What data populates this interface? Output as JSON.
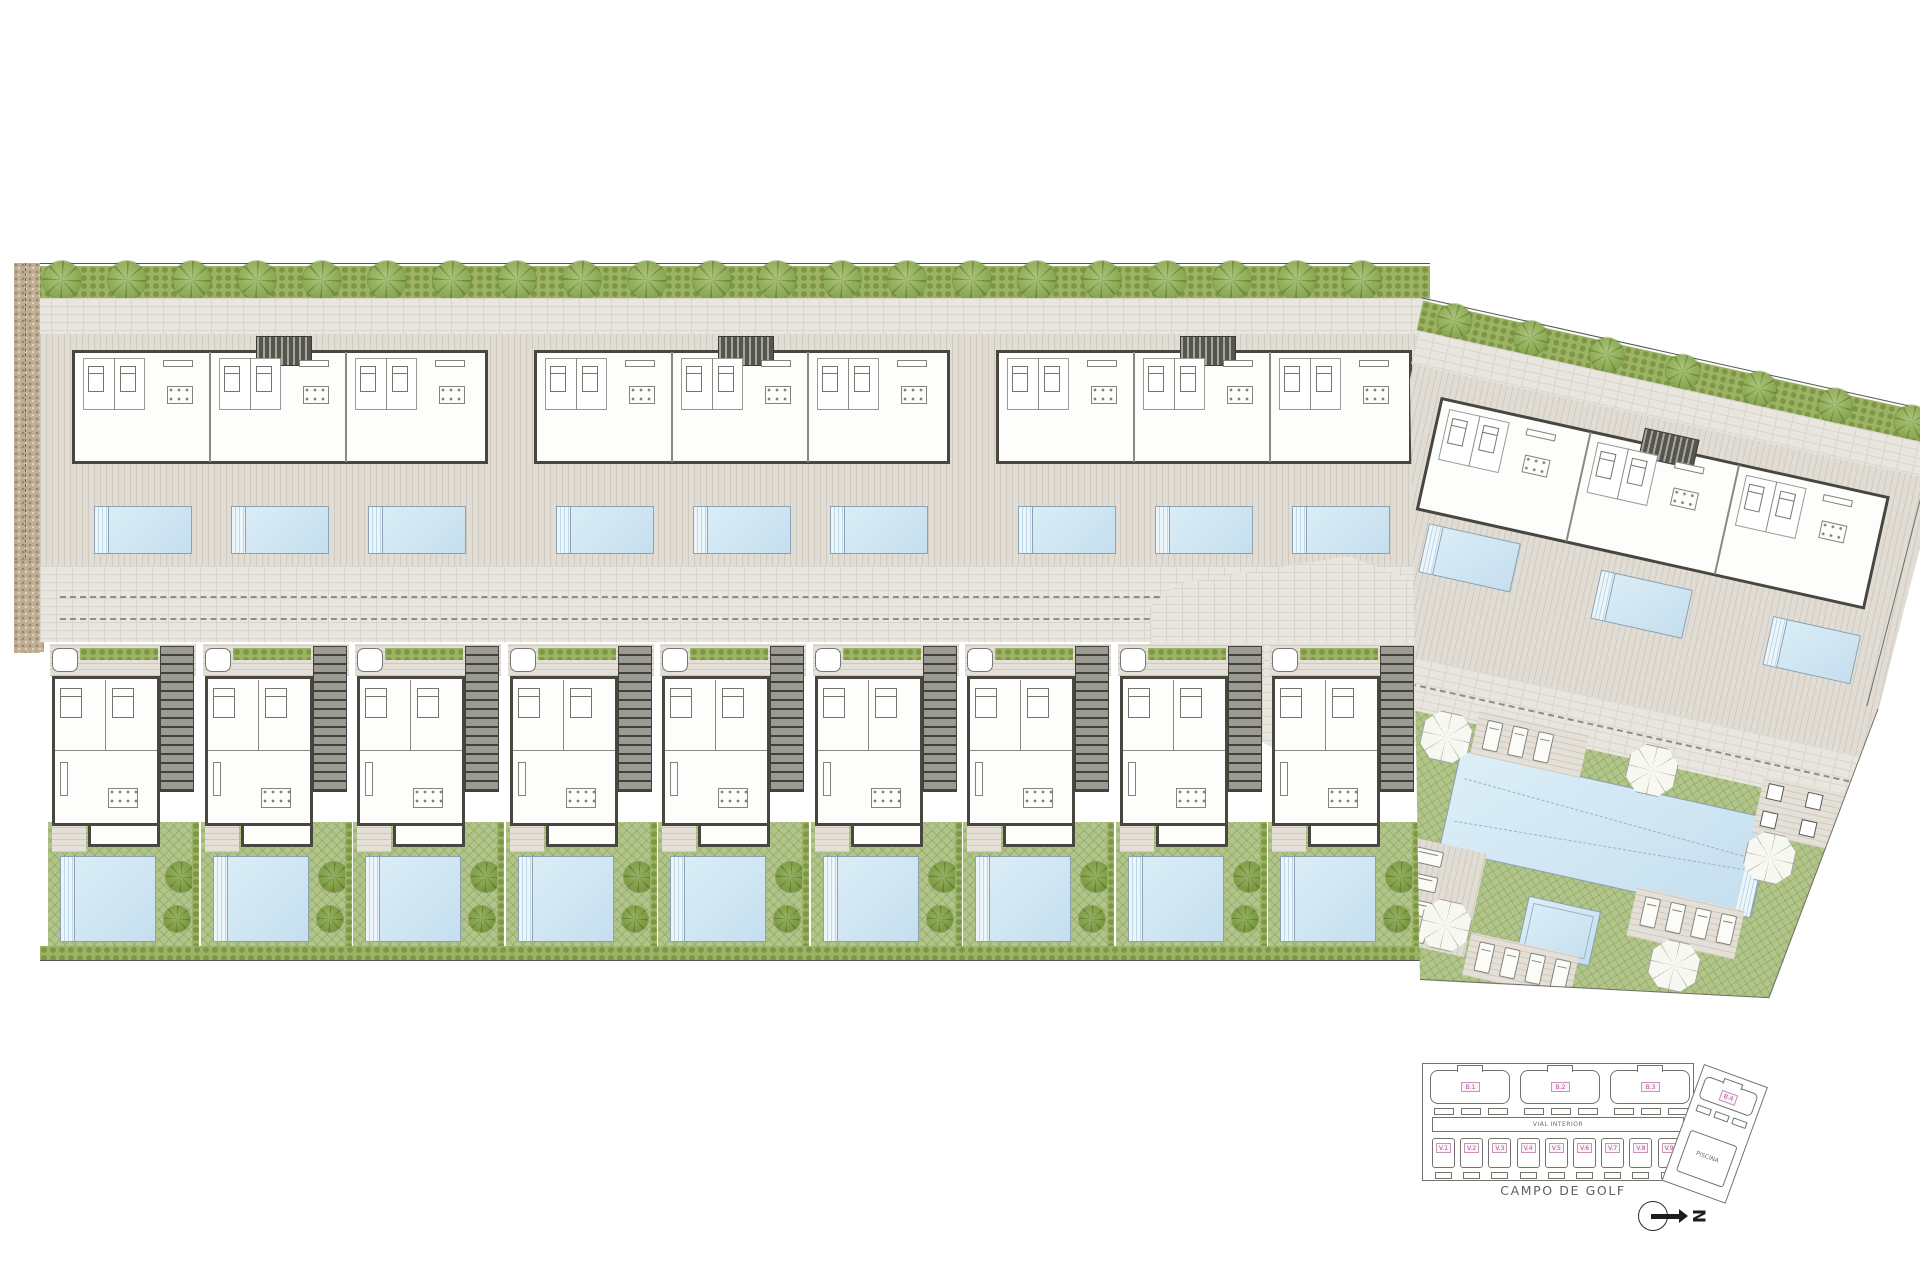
{
  "key_plan": {
    "block_labels": [
      "B.1",
      "B.2",
      "B.3",
      "B.4"
    ],
    "villa_labels": [
      "V.1",
      "V.2",
      "V.3",
      "V.4",
      "V.5",
      "V.6",
      "V.7",
      "V.8",
      "V.9"
    ],
    "road_label": "VIAL INTERIOR",
    "pool_building_label": "PISCINA",
    "golf_course_label": "CAMPO DE GOLF",
    "north_label": "N"
  },
  "site": {
    "apartment_blocks": 3,
    "units_per_block": 3,
    "pools_per_block": 3,
    "villas": 9,
    "right_block_units": 3,
    "right_block_pools": 3,
    "communal": {
      "main_pools": 1,
      "kids_pools": 1,
      "parasols": 6,
      "lounger_decks": 4
    }
  },
  "colors": {
    "lawn_green": "#b1c489",
    "hedge_green": "#9cb264",
    "pool_water": "#cfe5f2",
    "pavement": "#e9e6e0",
    "deck": "#e1ddd5",
    "wall_dark": "#47473f",
    "gravel_brown": "#bfae92",
    "label_pink": "#b2479a",
    "line_gray": "#73736c"
  }
}
